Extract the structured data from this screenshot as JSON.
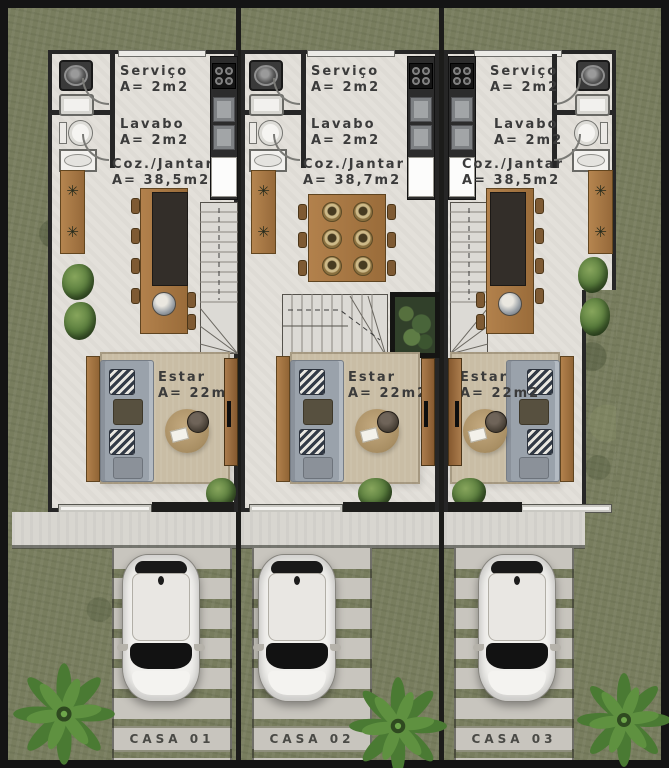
{
  "palette": {
    "frame": "#141414",
    "grass": "#787d5e",
    "floor": "#e3e0da",
    "wall": "#262626",
    "woodDark": "#7e5a33",
    "rug": "#c9bda5",
    "sofa": "#9aa2ab",
    "concrete": "#c8c5be",
    "counter": "#2c2c2c",
    "label": "#3b3b3b"
  },
  "icons": {
    "bench_plant": "✳"
  },
  "houses": [
    {
      "plate": "CASA 01",
      "servico": {
        "label": "Serviço",
        "area": "A= 2m2"
      },
      "lavabo": {
        "label": "Lavabo",
        "area": "A= 2m2"
      },
      "cozinha": {
        "label": "Coz./Jantar",
        "area": "A= 38,5m2"
      },
      "estar": {
        "label": "Estar",
        "area": "A= 22m2"
      }
    },
    {
      "plate": "CASA 02",
      "servico": {
        "label": "Serviço",
        "area": "A= 2m2"
      },
      "lavabo": {
        "label": "Lavabo",
        "area": "A= 2m2"
      },
      "cozinha": {
        "label": "Coz./Jantar",
        "area": "A= 38,7m2"
      },
      "estar": {
        "label": "Estar",
        "area": "A= 22m2"
      }
    },
    {
      "plate": "CASA 03",
      "servico": {
        "label": "Serviço",
        "area": "A= 2m2"
      },
      "lavabo": {
        "label": "Lavabo",
        "area": "A= 2m2"
      },
      "cozinha": {
        "label": "Coz./Jantar",
        "area": "A= 38,5m2"
      },
      "estar": {
        "label": "Estar",
        "area": "A= 22m2"
      }
    }
  ]
}
